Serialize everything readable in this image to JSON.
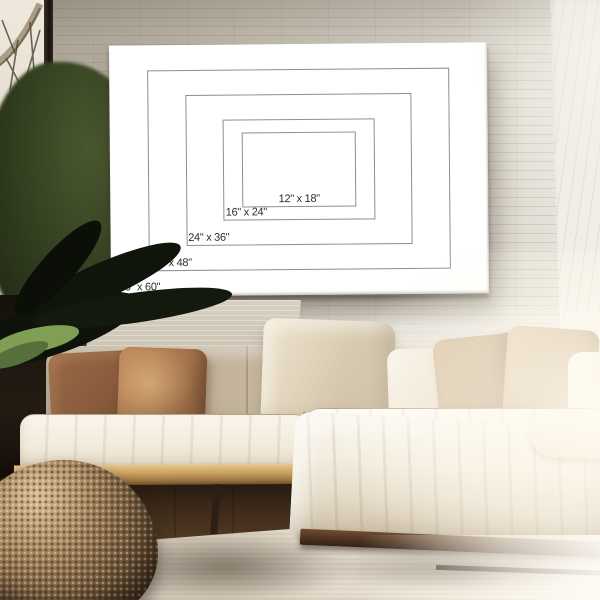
{
  "poster": {
    "name": "canvas-size-comparison-chart",
    "unit": "inches",
    "orientation": "landscape",
    "sizes": [
      {
        "id": "12x18",
        "label": "12\" x 18\"",
        "width_in": 18,
        "height_in": 12
      },
      {
        "id": "16x24",
        "label": "16\" x 24\"",
        "width_in": 24,
        "height_in": 16
      },
      {
        "id": "24x36",
        "label": "24\" x 36\"",
        "width_in": 36,
        "height_in": 24
      },
      {
        "id": "32x48",
        "label": "32\" x 48\"",
        "width_in": 48,
        "height_in": 32
      },
      {
        "id": "40x60",
        "label": "40\" x 60\"",
        "width_in": 60,
        "height_in": 40
      }
    ]
  },
  "scene": {
    "setting": "living room photo mockup",
    "objects": [
      "white painted brick wall",
      "window with tree branches view",
      "green indoor plant and dark leaves",
      "white canvas print with nested size outlines",
      "cream sectional sofa with chaise",
      "rust and tan throw pillows",
      "light oak sofa base",
      "round woven rattan pouf",
      "light area rug on dark wood floor",
      "sunlight from the right"
    ]
  },
  "palette": {
    "wall_left": "#aba496",
    "wall_bright": "#e8e5dd",
    "window_frame": "#17120d",
    "window_light": "#efe9dd",
    "foliage_dark": "#18200f",
    "foliage_mid": "#323f1f",
    "leaf_green": "#7c9a52",
    "canvas_white": "#ffffff",
    "diagram_line": "#8f8f8f",
    "diagram_text": "#2d2d2d",
    "sofa_cream": "#faf6ec",
    "sofa_taupe": "#b2a188",
    "pillow_rust": "#8a5c3c",
    "pillow_rust_light": "#a5754c",
    "pillow_tan": "#c2a783",
    "wood_base": "#c79e5e",
    "chaise_wood": "#4a3020",
    "floor_brown": "#45301d",
    "rug": "#cdc3b3",
    "pouf": "#7d6142",
    "pouf_dark": "#2a1e12"
  }
}
